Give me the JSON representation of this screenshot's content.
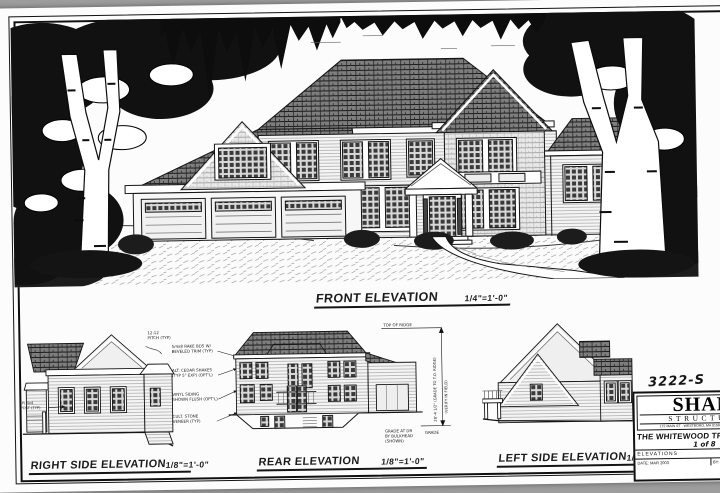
{
  "front": {
    "label": "FRONT ELEVATION",
    "scale": "1/4\"=1'-0\""
  },
  "right_side": {
    "label": "RIGHT SIDE ELEVATION",
    "scale": "1/8\"=1'-0\"",
    "note_pitch_1": "12:12",
    "note_pitch_2": "PITCH (TYP)",
    "note_post_1": "(P) 4x4",
    "note_post_2": "POST (TYP)"
  },
  "rear": {
    "label": "REAR ELEVATION",
    "scale": "1/8\"=1'-0\"",
    "notes": [
      "5/4x8 RAKE BDS W/",
      "BEVELED TRIM (TYP)",
      "ALT: CEDAR SHAKES",
      "(TYP 5\" EXP) (OPT'L)",
      "VINYL SIDING",
      "SHOWN FLUSH (OPT'L)",
      "CULT. STONE",
      "VENEER (TYP)"
    ],
    "dim_top": "TOP OF RIDGE",
    "dim_bottom": "GRADE",
    "dim_rot1": "28'-4 1/2\" (GRADE TO T.O. RIDGE)",
    "dim_rot2": "(VERIFY IN FIELD)",
    "corner_note": [
      "GRADE AT DR",
      "BY BULKHEAD",
      "(SHOWN)"
    ]
  },
  "left_side": {
    "label": "LEFT SIDE ELEVATION",
    "scale": "1/8\"=1'-0\""
  },
  "title_block": {
    "job_number": "3222-S",
    "brand_top": "SHANE",
    "brand_bottom": "STRUCTURES",
    "address": "172 MAIN ST · WESTBORO, MA 01581 · PH/FAX 508-366-0172",
    "project": "THE WHITEWOOD TRADITIONAL",
    "sheet": "1 of 8",
    "drawing_row": "ELEVATIONS",
    "cell_left": "DATE: MAR 2003",
    "cell_right": "BY: SCOTT SHANE"
  }
}
